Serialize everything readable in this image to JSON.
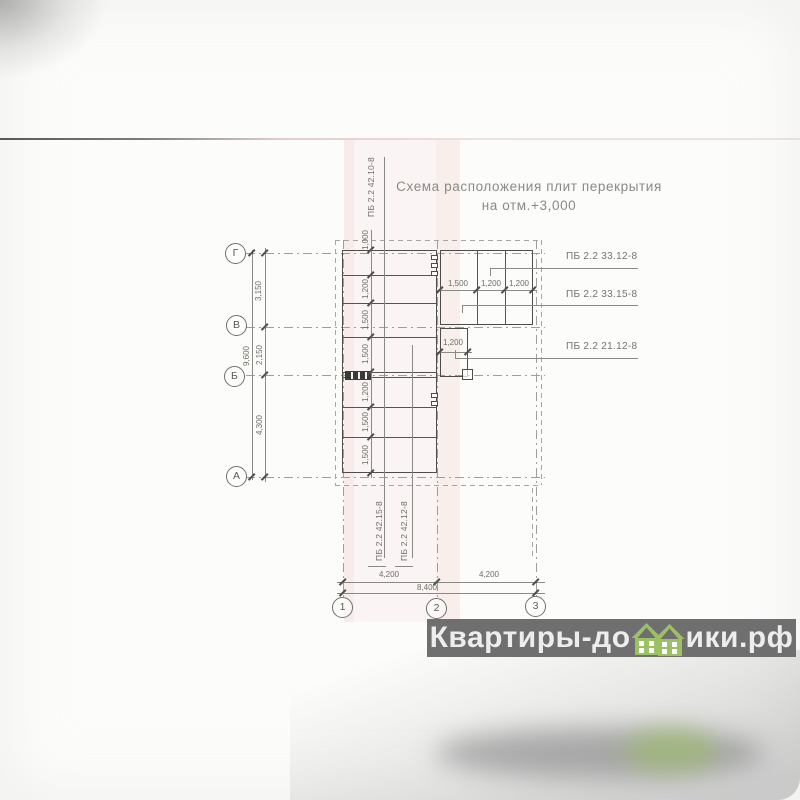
{
  "document": {
    "title_line1": "Схема расположения плит перекрытия",
    "title_line2": "на отм.+3,000"
  },
  "plan": {
    "row_axes": [
      "Г",
      "В",
      "Б",
      "А"
    ],
    "column_axes": [
      "1",
      "2",
      "3"
    ],
    "slab_marks": {
      "top": "ПБ 2.2 42.10-8",
      "bottom_left": "ПБ 2.2 42.15-8",
      "bottom_right": "ПБ 2.2 42.12-8",
      "right_top": "ПБ 2.2 33.12-8",
      "right_middle": "ПБ 2.2 33.15-8",
      "right_bottom": "ПБ 2.2 21.12-8"
    },
    "dims": {
      "left_chain": [
        "3,150",
        "2,150",
        "4,300"
      ],
      "left_total": "9,600",
      "bottom_chain": [
        "4,200",
        "4,200"
      ],
      "bottom_total": "8,400",
      "slab_rows": [
        "1,000",
        "1,200",
        "1,500",
        "1,500",
        "1,200",
        "1,500",
        "1,500"
      ],
      "top_right_slabs": [
        "1,500",
        "1,200",
        "1,200"
      ],
      "small_slab": "1,200"
    }
  },
  "watermark": {
    "prefix": "Квартиры-до",
    "suffix": "ики.рф",
    "icon": "green-houses-icon",
    "bar_color": "#6f6f6f",
    "text_color": "#ededed",
    "house_color": "#9cc162"
  }
}
